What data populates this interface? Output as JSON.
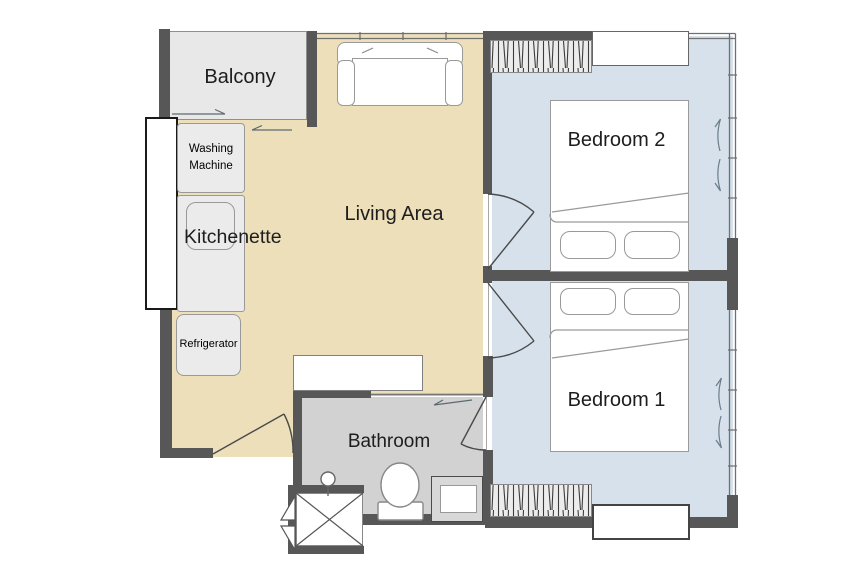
{
  "plan": {
    "rooms": {
      "balcony": {
        "label": "Balcony",
        "fill": "#e8e8e8"
      },
      "living": {
        "label": "Living Area",
        "fill": "#ecdfba"
      },
      "bedroom2": {
        "label": "Bedroom 2",
        "fill": "#d6e1ec"
      },
      "bedroom1": {
        "label": "Bedroom 1",
        "fill": "#d6e1ec"
      },
      "bathroom": {
        "label": "Bathroom",
        "fill": "#d2d2d2"
      }
    },
    "fixtures": {
      "washing_machine": {
        "label": "Washing Machine"
      },
      "kitchenette": {
        "label": "Kitchenette"
      },
      "refrigerator": {
        "label": "Refrigerator"
      }
    },
    "colors": {
      "wall": "#575757",
      "text": "#1d1d1d",
      "furniture_outline": "#999999",
      "wardrobe_fill": "#ececec",
      "window_line": "#707070"
    }
  }
}
